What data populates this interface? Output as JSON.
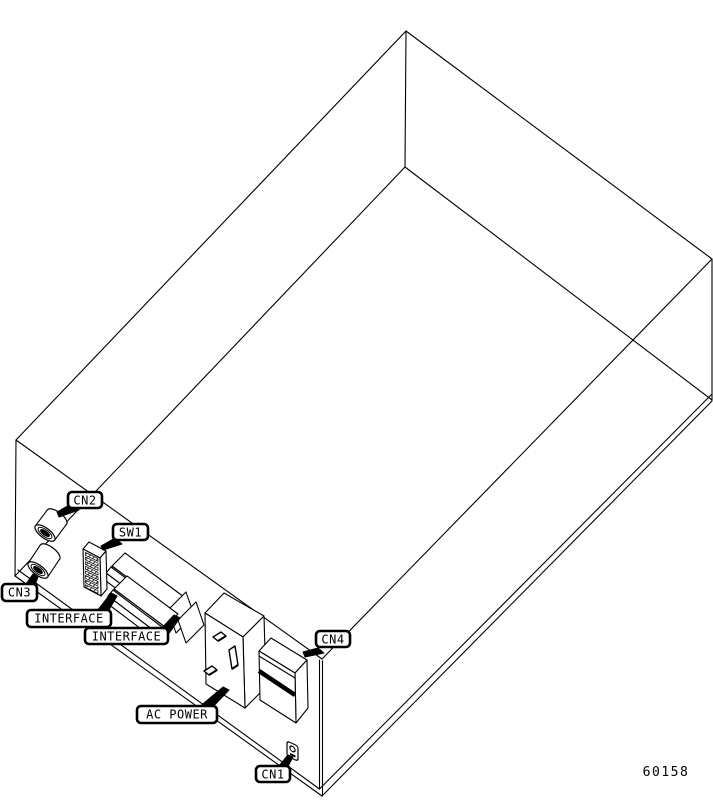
{
  "diagram": {
    "description": "Isometric line drawing of equipment chassis rear panel with labeled connectors",
    "figure_number": "60158",
    "callouts": {
      "cn2": "CN2",
      "cn3": "CN3",
      "sw1": "SW1",
      "interface_upper": "INTERFACE",
      "interface_lower": "INTERFACE",
      "ac_power": "AC POWER",
      "cn4": "CN4",
      "cn1": "CN1"
    },
    "components": {
      "cn2": "coaxial jack connector",
      "cn3": "coaxial jack connector",
      "sw1": "DIP switch block",
      "interface_upper": "edge interface connector",
      "interface_lower": "edge interface connector",
      "ac_power": "AC power outlet block",
      "cn4": "connector block with stripe",
      "cn1": "small round jack"
    },
    "colors": {
      "line": "#000000",
      "background": "#ffffff"
    }
  }
}
